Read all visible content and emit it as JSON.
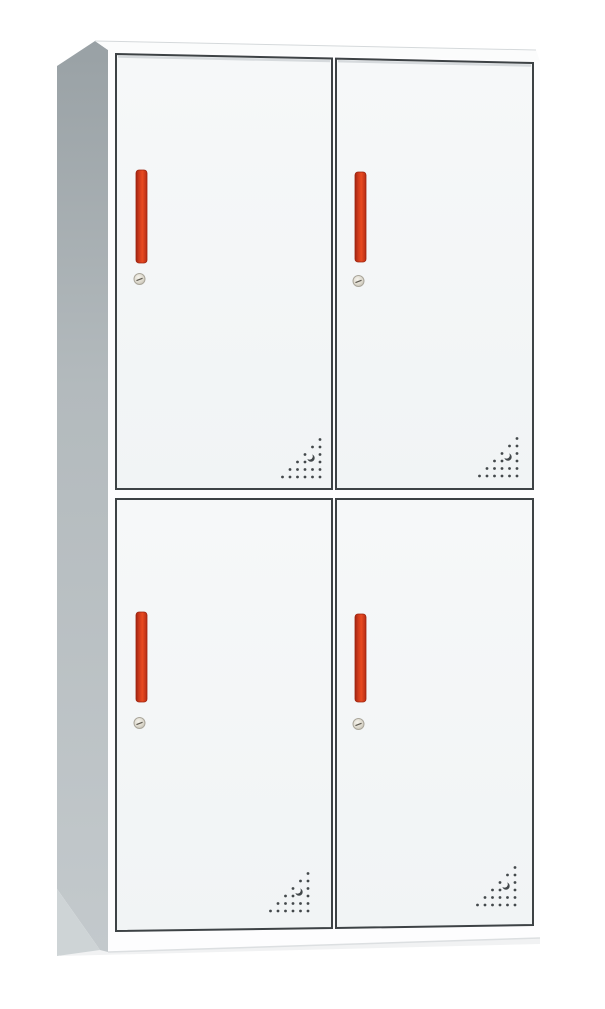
{
  "image": {
    "description": "Product photo of a white four-door steel locker cabinet shown in front-left perspective, two compartments wide and two tall, each door with a vertical orange-red handle, a round cam lock below the handle, and a triangular pattern of ventilation holes with a crescent-shaped cutout near the bottom corner of each door",
    "background": "#ffffff",
    "door_count": 4
  },
  "palette": {
    "background": "#ffffff",
    "side_dark": "#99a1a5",
    "side_mid": "#b4bbbe",
    "side_light": "#ced4d6",
    "top_face": "#fbfcfc",
    "top_edge_line": "#d5d9db",
    "front_face": "#fdfdfe",
    "door_face": "#f5f7f8",
    "door_face_low": "#f1f4f5",
    "frame_line": "#3d4245",
    "top_shade": "#ccd1d4",
    "handle_dark": "#a02512",
    "handle_bright": "#e84a21",
    "handle_edge": "#9c2410",
    "lock_light": "#f5f3ec",
    "lock_mid": "#ddd9cd",
    "lock_rim": "#aaa69b",
    "lock_slot": "#5f5b52",
    "vent_dot": "#43484b",
    "base_edge": "#dcdfe1",
    "shadow": "#f1f2f3"
  },
  "cabinet": {
    "shadow_poly": [
      [
        60,
        948
      ],
      [
        540,
        936
      ],
      [
        540,
        944
      ],
      [
        60,
        956
      ]
    ],
    "side_face": [
      [
        57,
        66
      ],
      [
        95,
        41
      ],
      [
        108,
        50
      ],
      [
        108,
        952
      ],
      [
        100,
        950
      ],
      [
        57,
        889
      ]
    ],
    "side_base_triangle": [
      [
        57,
        889
      ],
      [
        100,
        950
      ],
      [
        57,
        956
      ]
    ],
    "top_face": [
      [
        95,
        41
      ],
      [
        536,
        50
      ],
      [
        540,
        61
      ],
      [
        108,
        50
      ]
    ],
    "front_face": [
      [
        108,
        50
      ],
      [
        540,
        61
      ],
      [
        540,
        938
      ],
      [
        108,
        952
      ]
    ],
    "base_edge_line": [
      [
        108,
        952
      ],
      [
        540,
        938
      ]
    ],
    "doors": [
      {
        "id": "top-left",
        "points": [
          [
            116,
            54
          ],
          [
            332,
            58.5
          ],
          [
            332,
            489
          ],
          [
            116,
            489
          ]
        ],
        "top_shade": true,
        "handle": {
          "x": 136,
          "y": 170,
          "w": 11,
          "h": 93
        },
        "lock": {
          "cx": 139.5,
          "cy": 279,
          "r": 5.5
        },
        "vent": {
          "right": 320,
          "bottom": 477
        }
      },
      {
        "id": "top-right",
        "points": [
          [
            336,
            58.6
          ],
          [
            533,
            63
          ],
          [
            533,
            489
          ],
          [
            336,
            489
          ]
        ],
        "top_shade": true,
        "handle": {
          "x": 355,
          "y": 172,
          "w": 11,
          "h": 90
        },
        "lock": {
          "cx": 358.5,
          "cy": 281,
          "r": 5.5
        },
        "vent": {
          "right": 517,
          "bottom": 476
        }
      },
      {
        "id": "bottom-left",
        "points": [
          [
            116,
            499
          ],
          [
            332,
            499
          ],
          [
            332,
            928
          ],
          [
            116,
            931
          ]
        ],
        "top_shade": false,
        "handle": {
          "x": 136,
          "y": 612,
          "w": 11,
          "h": 90
        },
        "lock": {
          "cx": 139.5,
          "cy": 723,
          "r": 5.5
        },
        "vent": {
          "right": 308,
          "bottom": 911
        }
      },
      {
        "id": "bottom-right",
        "points": [
          [
            336,
            499
          ],
          [
            533,
            499
          ],
          [
            533,
            925
          ],
          [
            336,
            928
          ]
        ],
        "top_shade": false,
        "handle": {
          "x": 355,
          "y": 614,
          "w": 11,
          "h": 88
        },
        "lock": {
          "cx": 358.5,
          "cy": 724,
          "r": 5.5
        },
        "vent": {
          "right": 515,
          "bottom": 905
        }
      }
    ],
    "vent_pattern": {
      "rows": 6,
      "spacing": 7.5,
      "dot_radius": 1.4,
      "crescent": {
        "dx": -9,
        "dy": -19,
        "r_outer": 3.7,
        "cover_dx": -1.5,
        "cover_dy": -1.7,
        "r_cover": 3.3
      },
      "skip": [
        [
          3,
          1
        ],
        [
          4,
          1
        ]
      ]
    }
  }
}
